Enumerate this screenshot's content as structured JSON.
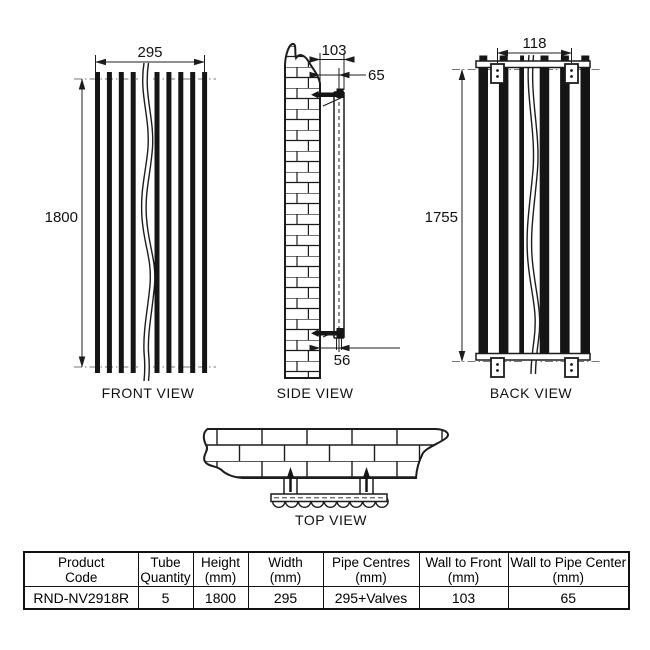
{
  "colors": {
    "line": "#1c1c1c",
    "background": "#ffffff"
  },
  "drawing": {
    "front": {
      "label": "FRONT VIEW",
      "width_dim": "295",
      "height_dim": "1800"
    },
    "side": {
      "label": "SIDE VIEW",
      "wall_to_front_dim": "103",
      "wall_to_pipe_top_dim": "65",
      "wall_to_pipe_bottom_dim": "56"
    },
    "back": {
      "label": "BACK VIEW",
      "bracket_centres_dim": "118",
      "bracket_height_dim": "1755"
    },
    "top": {
      "label": "TOP VIEW"
    }
  },
  "table": {
    "headers": [
      {
        "line1": "Product",
        "line2": "Code"
      },
      {
        "line1": "Tube",
        "line2": "Quantity"
      },
      {
        "line1": "Height",
        "line2": "(mm)"
      },
      {
        "line1": "Width",
        "line2": "(mm)"
      },
      {
        "line1": "Pipe Centres",
        "line2": "(mm)"
      },
      {
        "line1": "Wall to Front",
        "line2": "(mm)"
      },
      {
        "line1": "Wall to Pipe Center",
        "line2": "(mm)"
      }
    ],
    "row": {
      "product_code": "RND-NV2918R",
      "tube_quantity": "5",
      "height": "1800",
      "width": "295",
      "pipe_centres": "295+Valves",
      "wall_to_front": "103",
      "wall_to_pipe_center": "65"
    }
  }
}
